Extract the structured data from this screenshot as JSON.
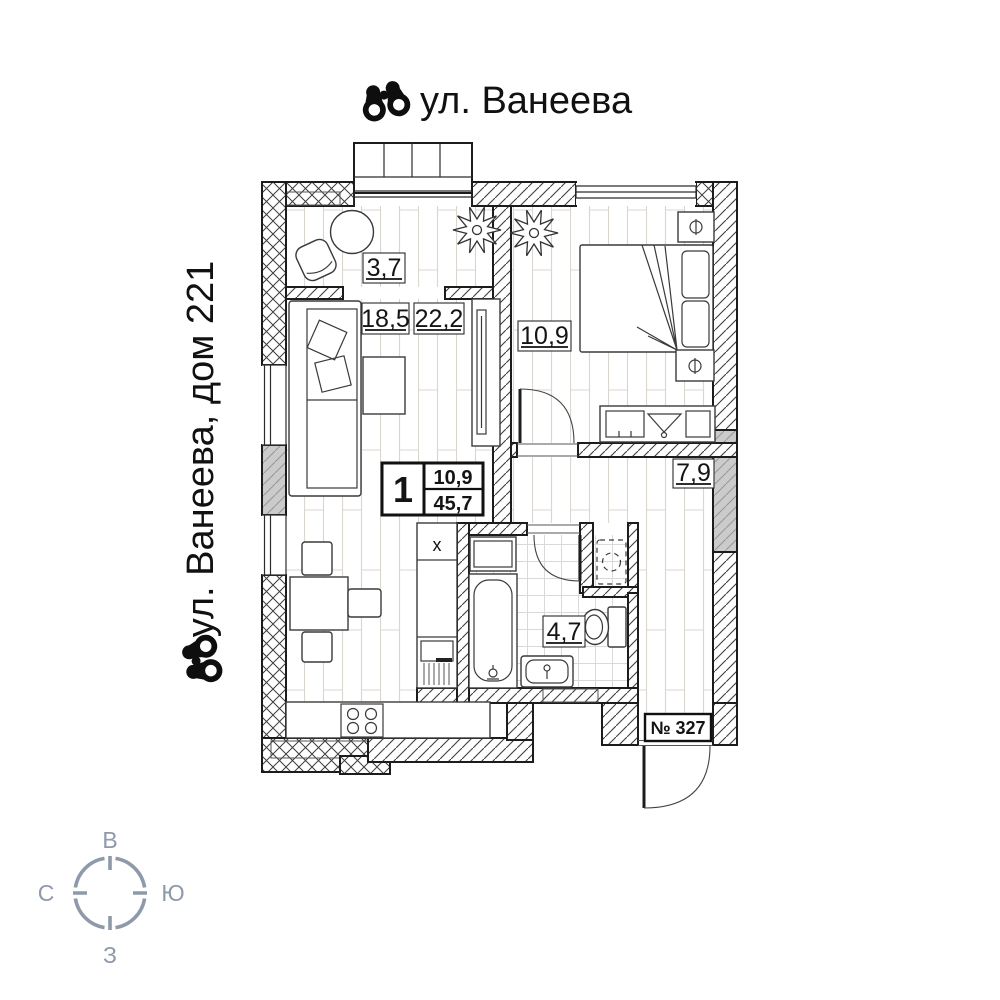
{
  "titles": {
    "top_street": "ул. Ванеева",
    "side_building": "ул. Ванеева, дом 221"
  },
  "plan": {
    "apartment_label": "№ 327",
    "info_box": {
      "rooms_count": "1",
      "value_top": "10,9",
      "value_bottom": "45,7"
    },
    "room_areas": {
      "balcony": "3,7",
      "living": "18,5",
      "kitchen_living": "22,2",
      "bedroom": "10,9",
      "hallway": "7,9",
      "bathroom": "4,7"
    },
    "kitchen_sink_mark": "x"
  },
  "compass": {
    "top": "В",
    "right": "Ю",
    "bottom": "З",
    "left": "С"
  },
  "colors": {
    "line": "#1c1c1c",
    "wall_gray": "#cbcbcb",
    "compass": "#8e99a9",
    "floor_line": "#dbd6cf"
  }
}
